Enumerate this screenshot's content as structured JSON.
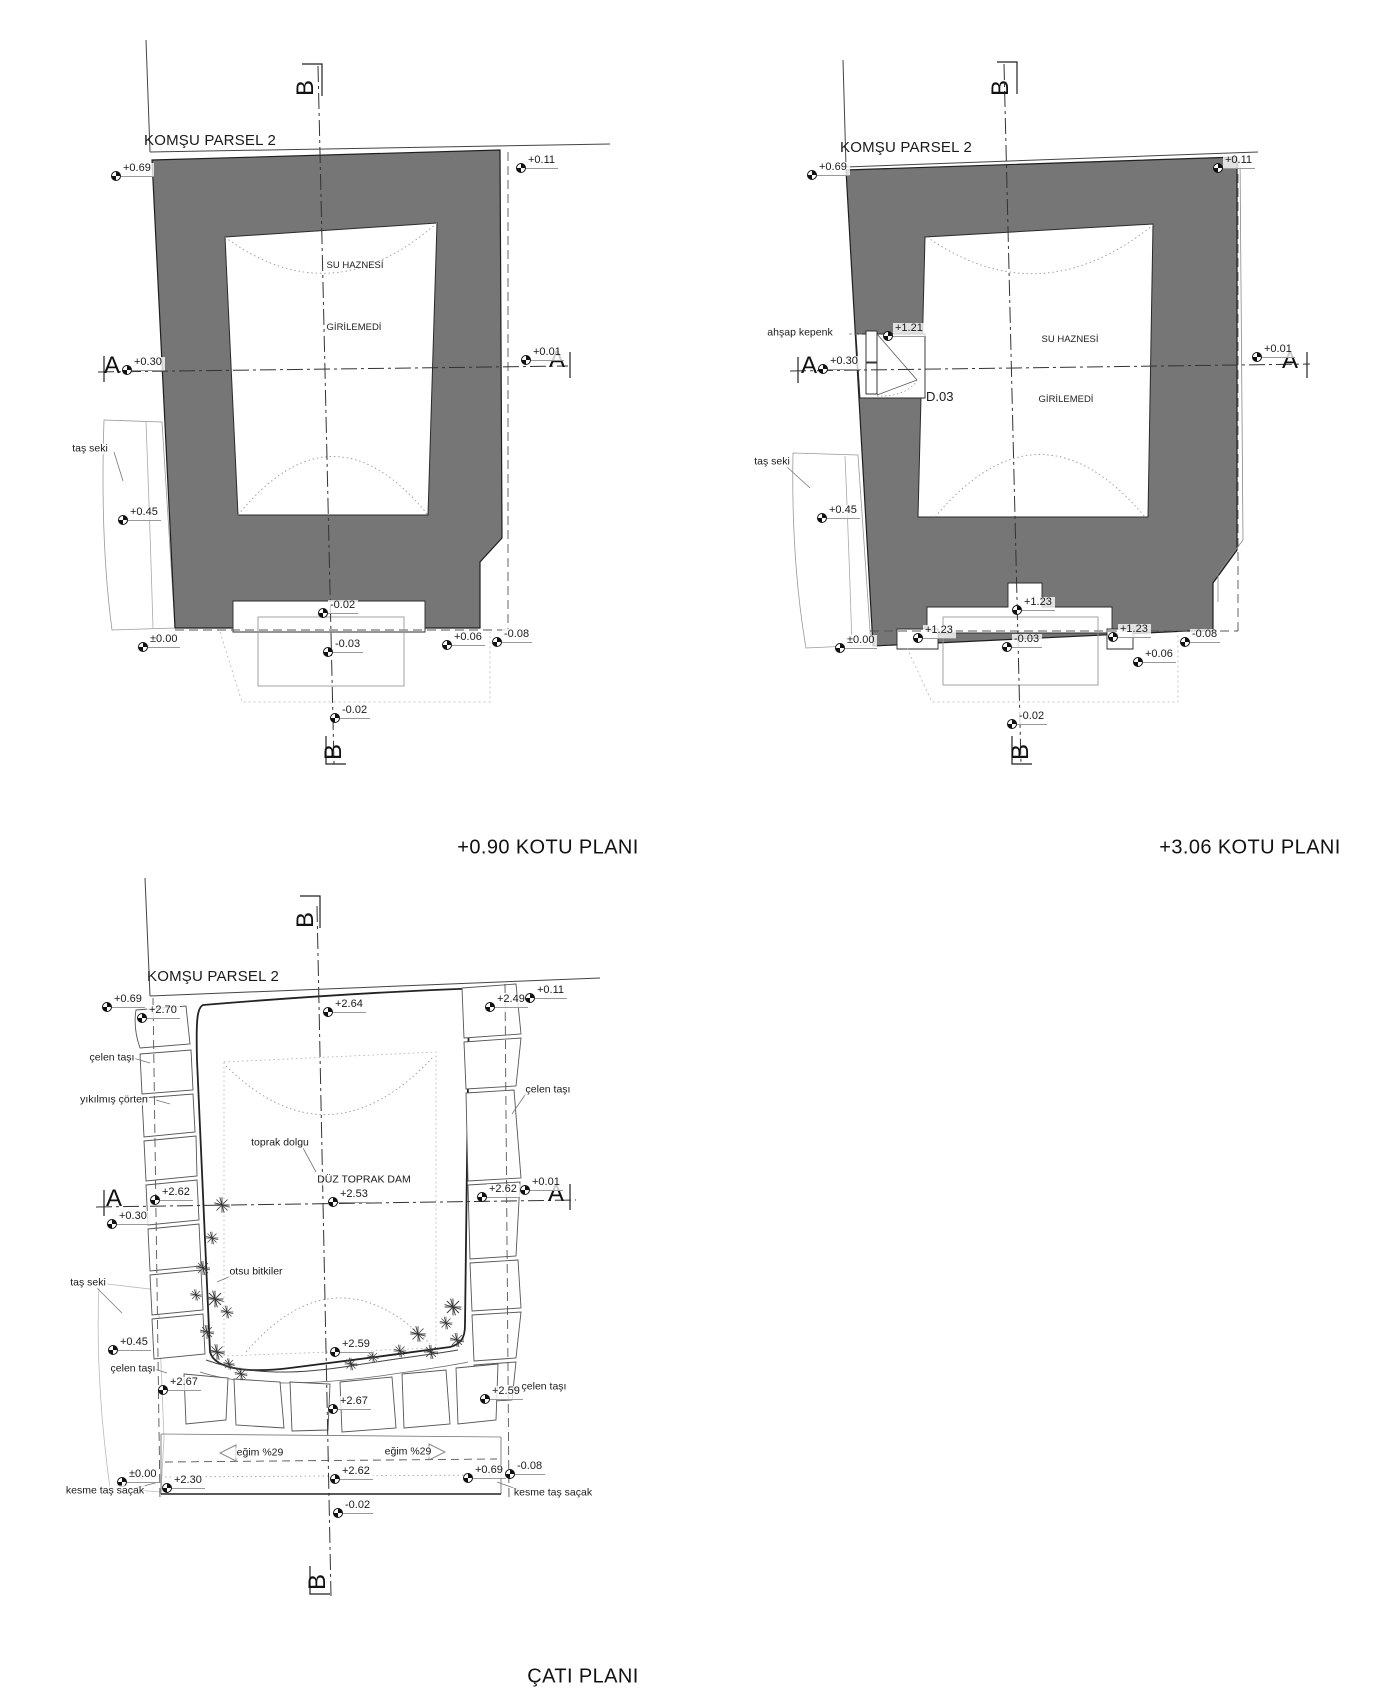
{
  "document": {
    "kind": "architectural survey drawing",
    "language": "tr"
  },
  "plans": [
    {
      "id": "kotu-090",
      "title": "+0.90 KOTU PLANI",
      "title_x": 548,
      "title_y": 848,
      "markers": [
        {
          "t": "label",
          "text": "KOMŞU PARSEL 2",
          "x": 210,
          "y": 141,
          "cls": "big"
        },
        {
          "t": "section",
          "text": "B",
          "x": 306,
          "y": 88,
          "rot": true
        },
        {
          "t": "section",
          "text": "B",
          "x": 334,
          "y": 752,
          "rot": true
        },
        {
          "t": "section",
          "text": "A",
          "x": 112,
          "y": 366
        },
        {
          "t": "section",
          "text": "A",
          "x": 557,
          "y": 360
        },
        {
          "t": "level",
          "text": "+0.69",
          "x": 116,
          "y": 176
        },
        {
          "t": "level",
          "text": "+0.11",
          "x": 521,
          "y": 168
        },
        {
          "t": "level",
          "text": "+0.30",
          "x": 127,
          "y": 370
        },
        {
          "t": "level",
          "text": "+0.01",
          "x": 526,
          "y": 360
        },
        {
          "t": "level",
          "text": "+0.45",
          "x": 123,
          "y": 520
        },
        {
          "t": "level",
          "text": "±0.00",
          "x": 143,
          "y": 647
        },
        {
          "t": "level",
          "text": "-0.02",
          "x": 323,
          "y": 613
        },
        {
          "t": "level",
          "text": "-0.03",
          "x": 328,
          "y": 652
        },
        {
          "t": "level",
          "text": "+0.06",
          "x": 447,
          "y": 645
        },
        {
          "t": "level",
          "text": "-0.08",
          "x": 497,
          "y": 642
        },
        {
          "t": "level",
          "text": "-0.02",
          "x": 335,
          "y": 718
        },
        {
          "t": "label",
          "text": "SU HAZNESİ",
          "x": 355,
          "y": 266,
          "cls": "room"
        },
        {
          "t": "label",
          "text": "GİRİLEMEDİ",
          "x": 354,
          "y": 328,
          "cls": "room"
        },
        {
          "t": "label",
          "text": "taş seki",
          "x": 90,
          "y": 449
        }
      ]
    },
    {
      "id": "kotu-306",
      "title": "+3.06 KOTU PLANI",
      "title_x": 1250,
      "title_y": 848,
      "markers": [
        {
          "t": "label",
          "text": "KOMŞU PARSEL 2",
          "x": 906,
          "y": 148,
          "cls": "big"
        },
        {
          "t": "section",
          "text": "B",
          "x": 1001,
          "y": 88,
          "rot": true
        },
        {
          "t": "section",
          "text": "B",
          "x": 1021,
          "y": 752,
          "rot": true
        },
        {
          "t": "section",
          "text": "A",
          "x": 809,
          "y": 366
        },
        {
          "t": "section",
          "text": "A",
          "x": 1290,
          "y": 361
        },
        {
          "t": "level",
          "text": "+0.69",
          "x": 812,
          "y": 175
        },
        {
          "t": "level",
          "text": "+0.11",
          "x": 1218,
          "y": 168
        },
        {
          "t": "level",
          "text": "+1.21",
          "x": 888,
          "y": 336
        },
        {
          "t": "level",
          "text": "+0.30",
          "x": 823,
          "y": 369
        },
        {
          "t": "level",
          "text": "+0.01",
          "x": 1257,
          "y": 357
        },
        {
          "t": "level",
          "text": "+0.45",
          "x": 822,
          "y": 518
        },
        {
          "t": "level",
          "text": "±0.00",
          "x": 840,
          "y": 648
        },
        {
          "t": "level",
          "text": "+1.23",
          "x": 918,
          "y": 638
        },
        {
          "t": "level",
          "text": "+1.23",
          "x": 1017,
          "y": 610
        },
        {
          "t": "level",
          "text": "+1.23",
          "x": 1113,
          "y": 637
        },
        {
          "t": "level",
          "text": "-0.03",
          "x": 1007,
          "y": 647
        },
        {
          "t": "level",
          "text": "+0.06",
          "x": 1138,
          "y": 662
        },
        {
          "t": "level",
          "text": "-0.08",
          "x": 1185,
          "y": 642
        },
        {
          "t": "level",
          "text": "-0.02",
          "x": 1012,
          "y": 724
        },
        {
          "t": "label",
          "text": "SU HAZNESİ",
          "x": 1070,
          "y": 340,
          "cls": "room"
        },
        {
          "t": "label",
          "text": "GİRİLEMEDİ",
          "x": 1066,
          "y": 400,
          "cls": "room"
        },
        {
          "t": "label",
          "text": "ahşap kepenk",
          "x": 800,
          "y": 333
        },
        {
          "t": "label",
          "text": "D.03",
          "x": 925,
          "y": 397,
          "cls": "door",
          "align": "left"
        },
        {
          "t": "label",
          "text": "taş seki",
          "x": 772,
          "y": 462
        }
      ]
    },
    {
      "id": "cati",
      "title": "ÇATI PLANI",
      "title_x": 583,
      "title_y": 1677,
      "markers": [
        {
          "t": "label",
          "text": "KOMŞU PARSEL 2",
          "x": 213,
          "y": 977,
          "cls": "big"
        },
        {
          "t": "section",
          "text": "B",
          "x": 306,
          "y": 920,
          "rot": true
        },
        {
          "t": "section",
          "text": "B",
          "x": 318,
          "y": 1582,
          "rot": true
        },
        {
          "t": "section",
          "text": "A",
          "x": 114,
          "y": 1199
        },
        {
          "t": "section",
          "text": "A",
          "x": 556,
          "y": 1194
        },
        {
          "t": "level",
          "text": "+0.69",
          "x": 107,
          "y": 1007
        },
        {
          "t": "level",
          "text": "+2.70",
          "x": 142,
          "y": 1018
        },
        {
          "t": "level",
          "text": "+2.64",
          "x": 328,
          "y": 1012
        },
        {
          "t": "level",
          "text": "+2.49",
          "x": 490,
          "y": 1007
        },
        {
          "t": "level",
          "text": "+0.11",
          "x": 530,
          "y": 998
        },
        {
          "t": "level",
          "text": "+2.62",
          "x": 155,
          "y": 1200
        },
        {
          "t": "level",
          "text": "+0.30",
          "x": 112,
          "y": 1224
        },
        {
          "t": "level",
          "text": "+2.53",
          "x": 333,
          "y": 1202
        },
        {
          "t": "level",
          "text": "+2.62",
          "x": 482,
          "y": 1197
        },
        {
          "t": "level",
          "text": "+0.01",
          "x": 525,
          "y": 1190
        },
        {
          "t": "level",
          "text": "+0.45",
          "x": 113,
          "y": 1350
        },
        {
          "t": "level",
          "text": "+2.67",
          "x": 163,
          "y": 1390
        },
        {
          "t": "level",
          "text": "+2.59",
          "x": 335,
          "y": 1352
        },
        {
          "t": "level",
          "text": "+2.59",
          "x": 485,
          "y": 1399
        },
        {
          "t": "level",
          "text": "+2.67",
          "x": 333,
          "y": 1409
        },
        {
          "t": "level",
          "text": "±0.00",
          "x": 122,
          "y": 1482
        },
        {
          "t": "level",
          "text": "+2.30",
          "x": 167,
          "y": 1488
        },
        {
          "t": "level",
          "text": "+2.62",
          "x": 335,
          "y": 1479
        },
        {
          "t": "level",
          "text": "+0.69",
          "x": 468,
          "y": 1478
        },
        {
          "t": "level",
          "text": "-0.08",
          "x": 510,
          "y": 1474
        },
        {
          "t": "level",
          "text": "-0.02",
          "x": 338,
          "y": 1513
        },
        {
          "t": "label",
          "text": "çelen taşı",
          "x": 112,
          "y": 1058
        },
        {
          "t": "label",
          "text": "yıkılmış çörten",
          "x": 114,
          "y": 1100
        },
        {
          "t": "label",
          "text": "çelen taşı",
          "x": 548,
          "y": 1090
        },
        {
          "t": "label",
          "text": "toprak dolgu",
          "x": 280,
          "y": 1143
        },
        {
          "t": "label",
          "text": "DÜZ TOPRAK DAM",
          "x": 364,
          "y": 1180
        },
        {
          "t": "label",
          "text": "taş seki",
          "x": 88,
          "y": 1283
        },
        {
          "t": "label",
          "text": "otsu bitkiler",
          "x": 256,
          "y": 1272
        },
        {
          "t": "label",
          "text": "çelen taşı",
          "x": 133,
          "y": 1369
        },
        {
          "t": "label",
          "text": "çelen taşı",
          "x": 544,
          "y": 1387
        },
        {
          "t": "label",
          "text": "eğim %29",
          "x": 260,
          "y": 1453
        },
        {
          "t": "label",
          "text": "eğim %29",
          "x": 408,
          "y": 1452
        },
        {
          "t": "label",
          "text": "kesme taş saçak",
          "x": 105,
          "y": 1491
        },
        {
          "t": "label",
          "text": "kesme taş saçak",
          "x": 553,
          "y": 1493
        },
        {
          "t": "label",
          "text": "-",
          "x": -100,
          "y": -100
        }
      ]
    }
  ]
}
